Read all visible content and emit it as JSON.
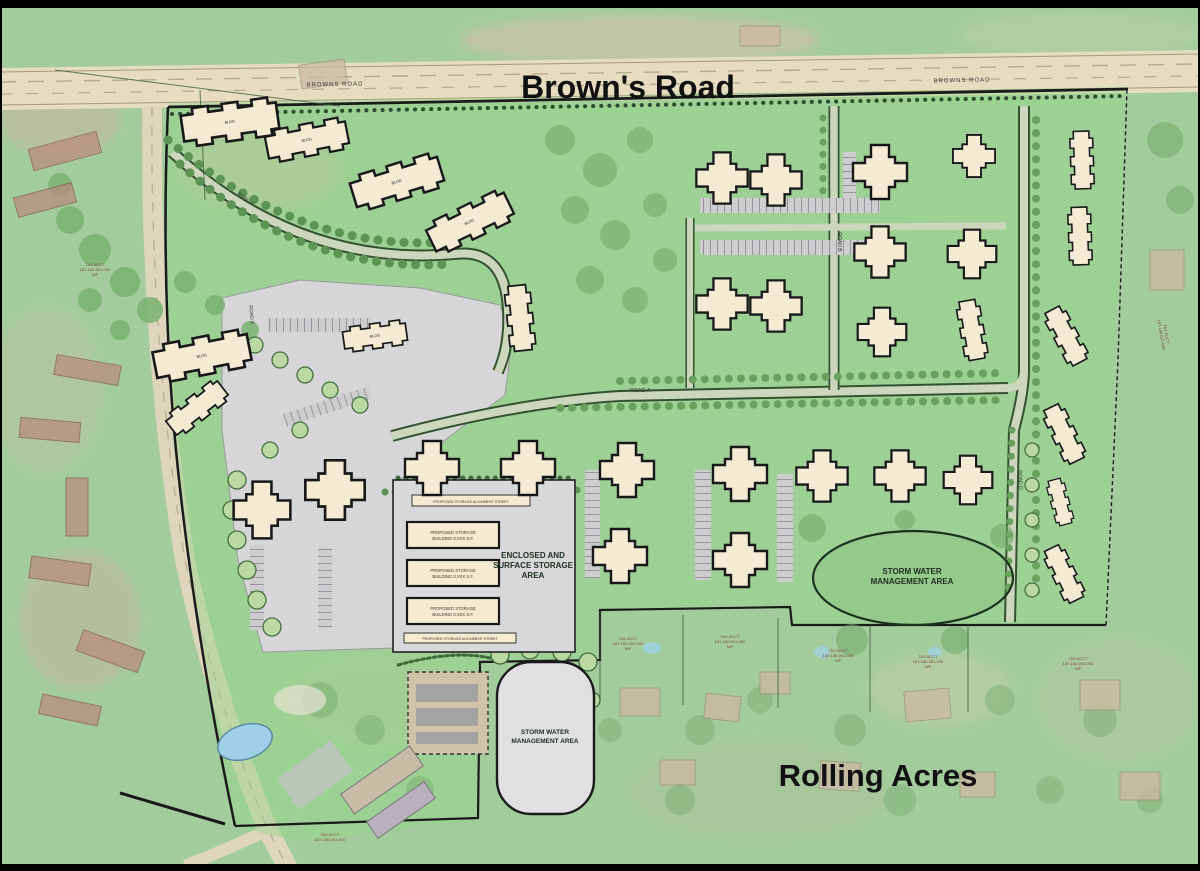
{
  "plan": {
    "main_road": "Brown's Road",
    "main_road_small": "BROWNS ROAD",
    "neighborhood": "Rolling Acres",
    "storm_water": [
      "STORM WATER",
      "MANAGEMENT AREA"
    ],
    "storage_area": [
      "ENCLOSED AND",
      "SURFACE STORAGE",
      "AREA"
    ],
    "storage_building": [
      "PROPOSED STORAGE",
      "BUILDING 8,XXX S.F."
    ],
    "storage_strip": "PROPOSED STORAGE ALIGNMENT STREET",
    "roads": {
      "a": "ROAD A",
      "b": "ROAD B",
      "c": "ROAD C",
      "d": "ROAD D",
      "e": "ROAD E"
    },
    "building_tag": "BLDG",
    "parcel_note": [
      "TAX ACCT",
      "187-180-001-000",
      "N/F"
    ],
    "colors": {
      "aerial_green": "#a3cc9c",
      "site_green": "#8fc687",
      "road_tan": "#e6ddc1",
      "paved_gray": "#d6d6d8",
      "building_fill": "#f4ebd2",
      "outline": "#1a1a1a",
      "pond_gray": "#e0e0e2",
      "pool_blue": "#9fd0e8"
    }
  }
}
